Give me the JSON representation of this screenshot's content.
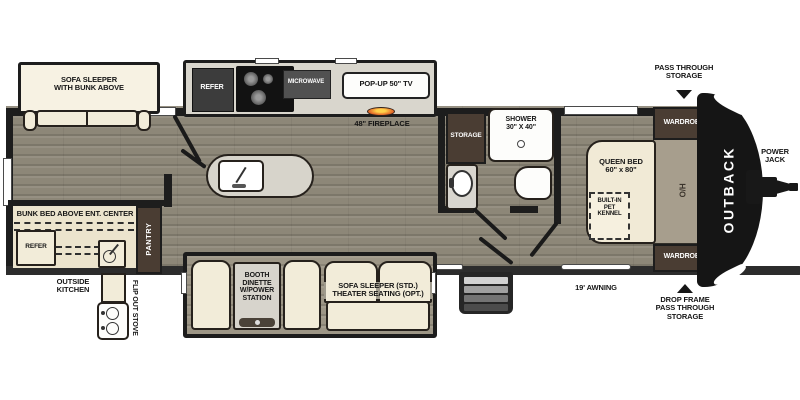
{
  "title": "Travel trailer floor plan",
  "colors": {
    "floor_wood": "#8d8778",
    "floor_slide_gray": "#d9d6cd",
    "floor_bunkroom": "#ece4cd",
    "furniture_cream": "#f2ecd9",
    "cabinet_brown": "#4a3d33",
    "wall_black": "#1d1d1d",
    "front_cap": "#151515",
    "flame_accent": "#e8752c"
  },
  "labels": {
    "sofa_bunk_l1": "SOFA SLEEPER",
    "sofa_bunk_l2": "WITH BUNK ABOVE",
    "refer_top": "REFER",
    "microwave": "MICROWAVE",
    "popup_tv": "POP-UP 50\" TV",
    "fireplace": "48\" FIREPLACE",
    "storage": "STORAGE",
    "shower_l1": "SHOWER",
    "shower_l2": "30\" X 40\"",
    "pass_through_l1": "PASS THROUGH",
    "pass_through_l2": "STORAGE",
    "wardrobe_top": "WARDROBE",
    "wardrobe_bottom": "WARDROBE",
    "queen_l1": "QUEEN BED",
    "queen_l2": "60\" x 80\"",
    "overhead": "O/H",
    "kennel_l1": "BUILT-IN",
    "kennel_l2": "PET",
    "kennel_l3": "KENNEL",
    "brand": "OUTBACK",
    "power_l1": "POWER",
    "power_l2": "JACK",
    "bunk_title": "BUNK BED ABOVE ENT. CENTER",
    "refer_bunk": "REFER",
    "pantry": "PANTRY",
    "outside_l1": "OUTSIDE",
    "outside_l2": "KITCHEN",
    "flip_stove": "FLIP OUT STOVE",
    "dinette_l1": "BOOTH",
    "dinette_l2": "DINETTE",
    "dinette_l3": "W/POWER",
    "dinette_l4": "STATION",
    "sofa_std_l1": "SOFA SLEEPER (STD.)",
    "sofa_std_l2": "THEATER SEATING (OPT.)",
    "awning": "19' AWNING",
    "drop_l1": "DROP FRAME",
    "drop_l2": "PASS THROUGH",
    "drop_l3": "STORAGE"
  }
}
